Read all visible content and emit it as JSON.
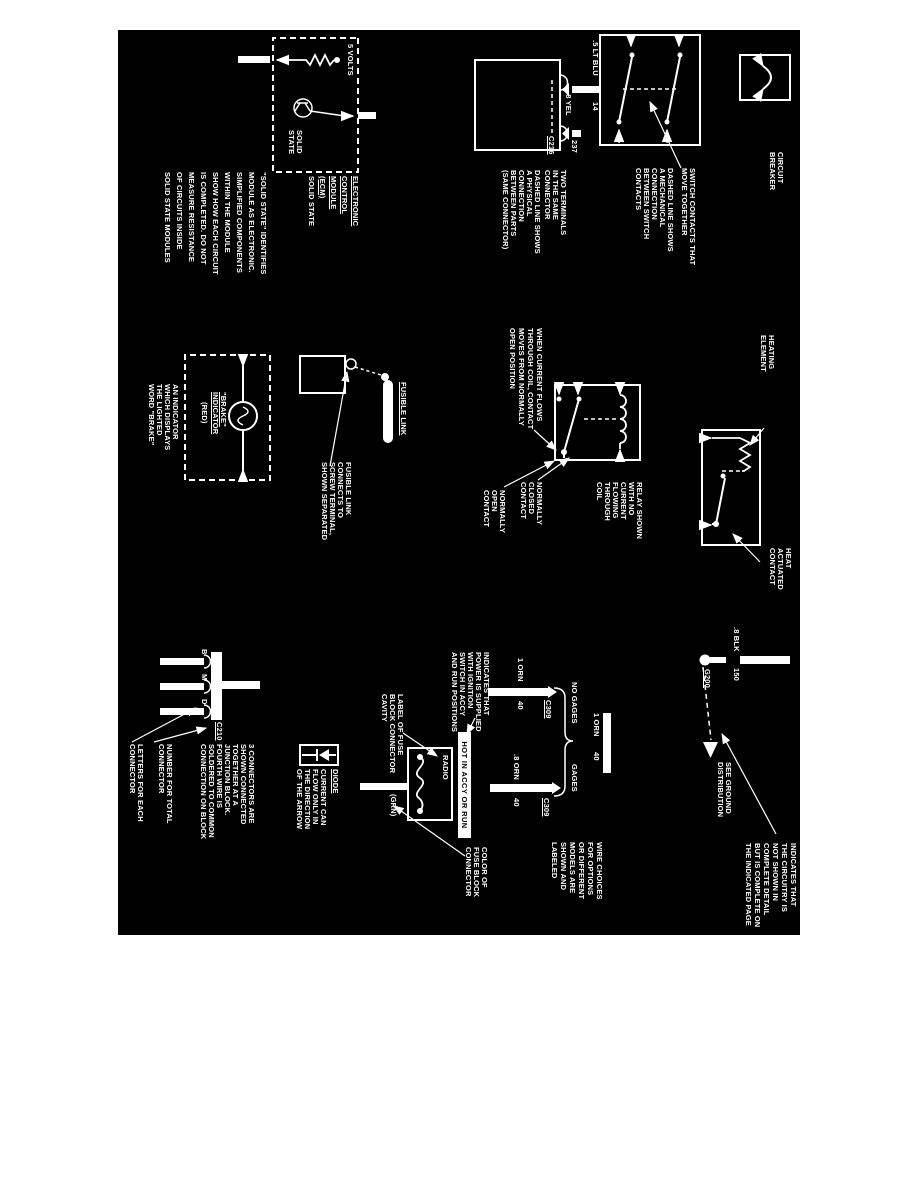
{
  "colors": {
    "paper": "#ffffff",
    "panel": "#000000",
    "ink": "#ffffff"
  },
  "blocks": {
    "circuit_breaker": {
      "label": "CIRCUIT\nBREAKER"
    },
    "switch": {
      "note1": "SWITCH CONTACTS THAT\nMOVE TOGETHER",
      "note2": "DASHED LINE SHOWS\nA MECHANICAL\nCONNECTION\nBETWEEN SWITCH\nCONTACTS",
      "wire_color": ".5 LT BLU",
      "wire_circuit": "14"
    },
    "connector": {
      "note1": "TWO TERMINALS\nIN THE SAME\nCONNECTOR",
      "note2": "DASHED LINE SHOWS\nA PHYSICAL\nCONNECTION\nBETWEEN PARTS\n(SAME CONNECTOR)",
      "wire_color": ".8 YEL",
      "wire_circuit": "237",
      "connector_id": "C216"
    },
    "ecm": {
      "volts": "5 VOLTS",
      "state": "SOLID\nSTATE",
      "title_underlined": "ELECTRONIC\nCONTROL\nMODULE\n(ECM)",
      "title_rest": "SOLID STATE",
      "note": "\"SOLID STATE\" IDENTIFIES\nMODULE AS ELECTRONIC.\nSIMPLIFIED COMPONENTS\nWITHIN THE MODULE\nSHOW HOW EACH CIRCUIT\nIS COMPLETED. DO NOT\nMEASURE RESISTANCE\nOF CIRCUITS INSIDE\nSOLID STATE MODULES"
    },
    "heat": {
      "element_label": "HEATING\nELEMENT",
      "contact_label": "HEAT\nACTUATED\nCONTACT"
    },
    "relay": {
      "note_main": "RELAY SHOWN\nWITH NO\nCURRENT\nFLOWING\nTHROUGH\nCOIL",
      "nc_label": "NORMALLY\nCLOSED\nCONTACT",
      "no_label": "NORMALLY\nOPEN\nCONTACT",
      "note_action": "WHEN CURRENT FLOWS\nTHROUGH COIL, CONTACT\nMOVES FROM NORMALLY\nOPEN POSITION"
    },
    "fusible_link": {
      "title": "FUSIBLE LINK",
      "note": "FUSIBLE LINK\nCONNECTS TO\nSCREW TERMINAL,\nSHOWN SEPARATED"
    },
    "brake": {
      "bulb_label_u": "\"BRAKE\"\nINDICATOR",
      "bulb_label_rest": "(RED)",
      "note": "AN INDICATOR\nWHICH DISPLAYS\nTHE LIGHTED\nWORD \"BRAKE\""
    },
    "ground": {
      "wire_color": ".8 BLK",
      "wire_circuit": "150",
      "ground_id": "G200",
      "see_label": "SEE GROUND\nDISTRIBUTION",
      "note": "INDICATES THAT\nTHE CIRCUITRY IS\nNOT SHOWN IN\nCOMPLETE DETAIL\nBUT IS COMPLETE ON\nTHE INDICATED PAGE"
    },
    "fuse": {
      "hot_label": "HOT IN ACCY OR RUN",
      "fuse_name": "RADIO",
      "connector_color": "(GRN)",
      "note_power": "INDICATES THAT\nPOWER IS SUPPLIED\nWITH IGNITION\nSWITCH IN ACCY\nAND RUN POSITIONS",
      "note_cavity": "LABEL OF FUSE\nBLOCK CONNECTOR\nCAVITY",
      "note_color": "COLOR OF\nFUSE BLOCK\nCONNECTOR"
    },
    "wire_choices": {
      "trunk_color": "1 ORN",
      "trunk_circuit": "40",
      "left_option": "NO GAGES",
      "left_color": "1 ORN",
      "left_circuit": "40",
      "left_connector": "C309",
      "right_option": "GAGES",
      "right_color": ".8 ORN",
      "right_circuit": "40",
      "right_connector": "C309",
      "note": "WIRE CHOICES\nFOR OPTIONS\nOR DIFFERENT\nMODELS ARE\nSHOWN AND\nLABELED"
    },
    "junction": {
      "connector_id": "C210",
      "letters": [
        "B",
        "M",
        "D"
      ],
      "note_main": "3 CONNECTORS ARE\nSHOWN CONNECTED\nTOGETHER AT A\nJUNCTION BLOCK.\nFOURTH WIRE IS\nSOLDERED TO COMMON\nCONNECTION ON BLOCK",
      "note_number": "NUMBER FOR TOTAL\nCONNECTOR",
      "note_letters": "LETTERS FOR EACH\nCONNECTOR"
    },
    "diode": {
      "title": "DIODE",
      "note": "CURRENT CAN\nFLOW ONLY IN\nTHE DIRECTION\nOF THE ARROW"
    }
  }
}
